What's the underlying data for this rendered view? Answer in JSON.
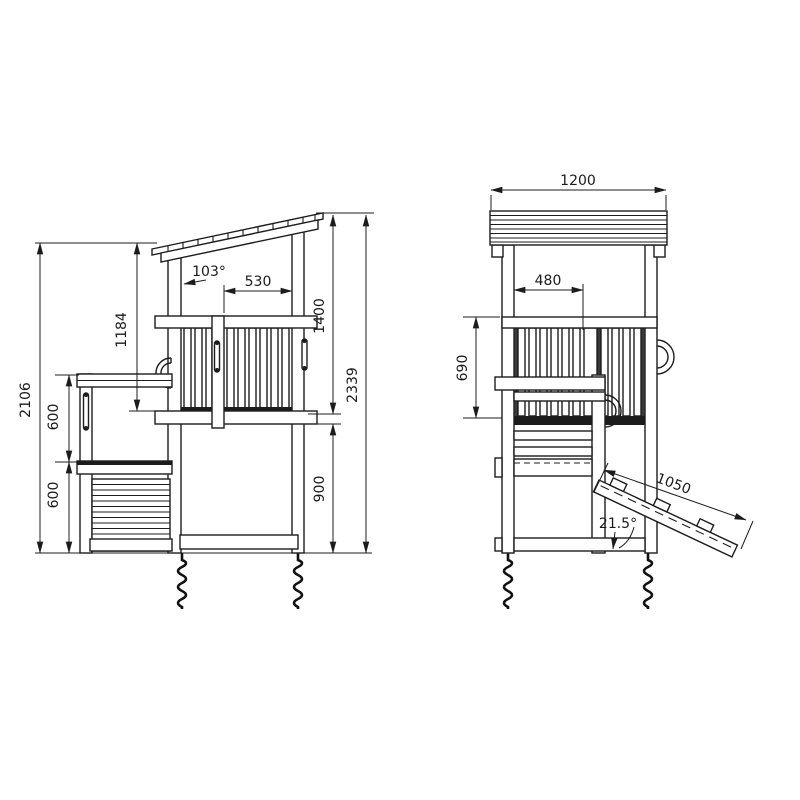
{
  "drawing": {
    "type": "technical-dimension-drawing",
    "subject": "play tower with roof, table, sandbox and climbing ramp",
    "background": "#ffffff",
    "line_color": "#1c1c1c"
  },
  "side_view": {
    "name": "side elevation",
    "dims": {
      "total_height_left": "2106",
      "platform_to_eave": "1184",
      "counter_upper": "600",
      "counter_lower": "600",
      "opening_width": "530",
      "roof_angle": "103°",
      "roof_to_platform": "1400",
      "platform_height": "900",
      "total_height_right": "2339"
    }
  },
  "front_view": {
    "name": "front elevation",
    "dims": {
      "roof_width": "1200",
      "post_to_center": "480",
      "rail_to_table": "690",
      "ramp_length": "1050",
      "ramp_angle": "21.5°"
    }
  }
}
